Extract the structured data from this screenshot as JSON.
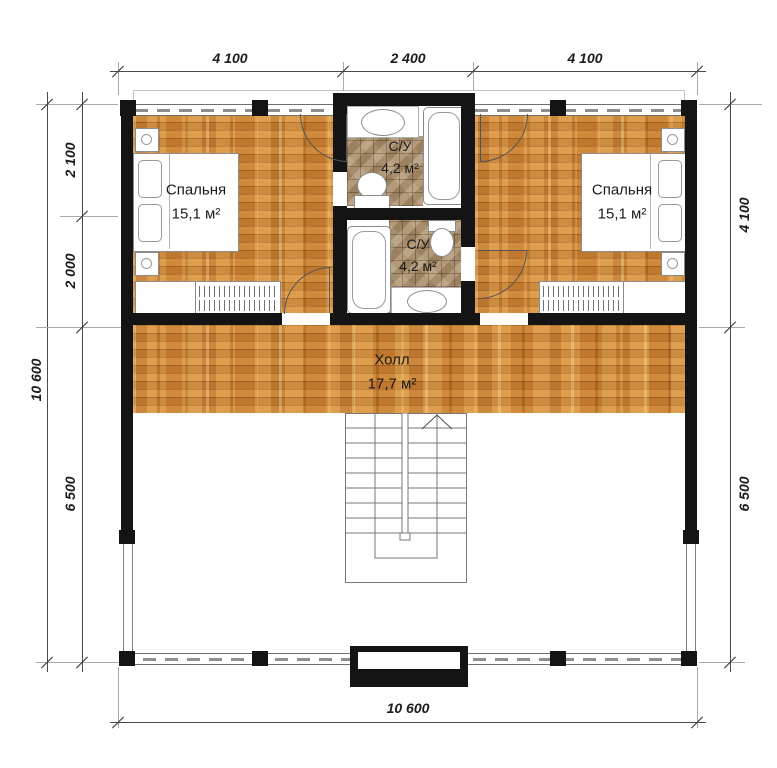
{
  "rooms": {
    "bedroom_left": {
      "name": "Спальня",
      "area": "15,1 м²"
    },
    "bedroom_right": {
      "name": "Спальня",
      "area": "15,1 м²"
    },
    "bath_top": {
      "name": "С/У",
      "area": "4,2 м²"
    },
    "bath_bottom": {
      "name": "С/У",
      "area": "4,2 м²"
    },
    "hall": {
      "name": "Холл",
      "area": "17,7 м²"
    }
  },
  "dimensions": {
    "top": [
      "4 100",
      "2 400",
      "4 100"
    ],
    "left_outer": "10 600",
    "left_inner": [
      "2 100",
      "2 000",
      "6 500"
    ],
    "right": [
      "4 100",
      "6 500"
    ],
    "bottom": "10 600"
  },
  "colors": {
    "wall": "#141414",
    "wood_floor": "#d18b3b",
    "tile_floor": "#a98e6c",
    "dimension_text": "#1c1c1c",
    "drawing_line": "#555555"
  }
}
